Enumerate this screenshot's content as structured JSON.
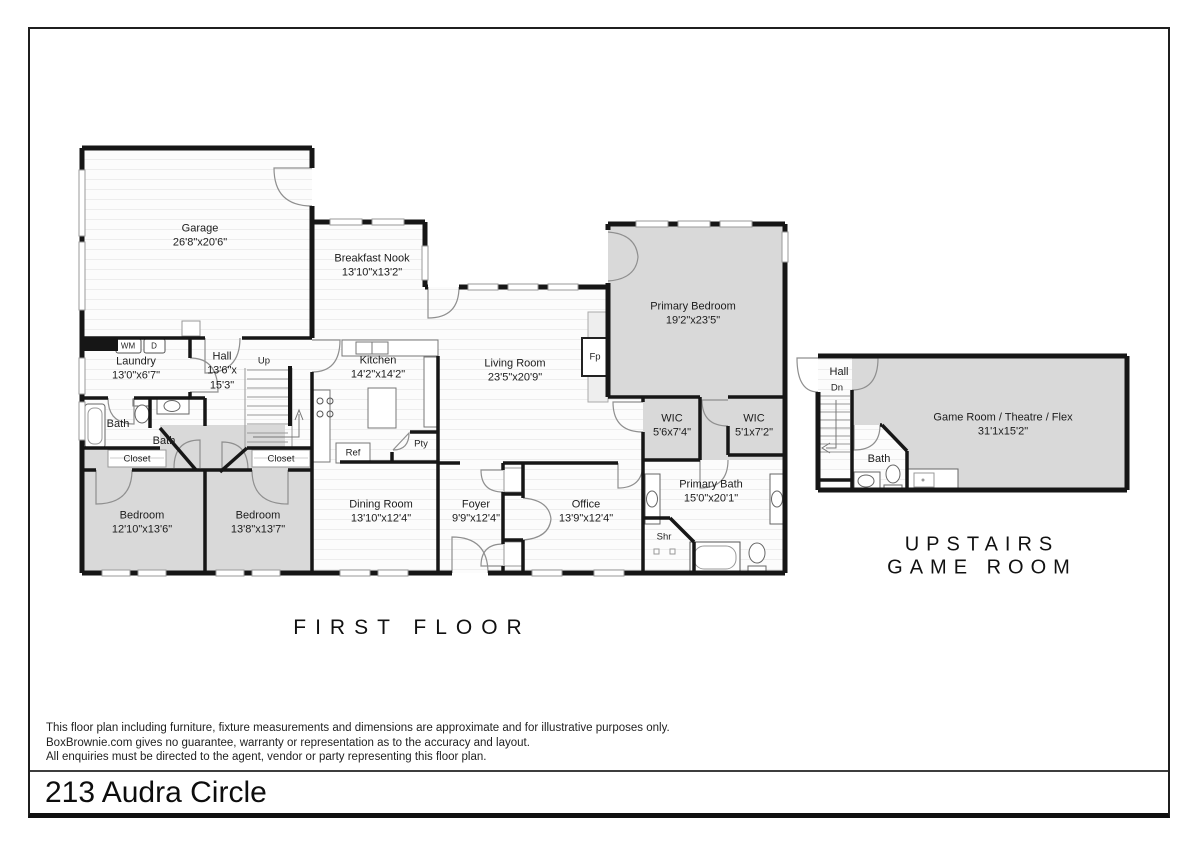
{
  "footer": {
    "address": "213 Audra Circle",
    "disclaimer": [
      "This floor plan including furniture, fixture measurements and dimensions are approximate and for illustrative purposes only.",
      "BoxBrownie.com gives no guarantee, warranty or representation as to the accuracy and layout.",
      "All enquiries must be directed to the agent, vendor or party representing this floor plan."
    ]
  },
  "sections": {
    "first_floor": "FIRST FLOOR",
    "upstairs_line1": "UPSTAIRS",
    "upstairs_line2": "GAME ROOM"
  },
  "rooms": {
    "garage": {
      "name": "Garage",
      "dims": "26'8\"x20'6\""
    },
    "breakfast_nook": {
      "name": "Breakfast Nook",
      "dims": "13'10\"x13'2\""
    },
    "kitchen": {
      "name": "Kitchen",
      "dims": "14'2\"x14'2\""
    },
    "living_room": {
      "name": "Living Room",
      "dims": "23'5\"x20'9\""
    },
    "primary_bedroom": {
      "name": "Primary Bedroom",
      "dims": "19'2\"x23'5\""
    },
    "laundry": {
      "name": "Laundry",
      "dims": "13'0\"x6'7\""
    },
    "hall": {
      "name": "Hall",
      "dims": "13'6\"x 15'3\""
    },
    "wic_left": {
      "name": "WIC",
      "dims": "5'6x7'4\""
    },
    "wic_right": {
      "name": "WIC",
      "dims": "5'1x7'2\""
    },
    "primary_bath": {
      "name": "Primary Bath",
      "dims": "15'0\"x20'1\""
    },
    "bedroom_left": {
      "name": "Bedroom",
      "dims": "12'10\"x13'6\""
    },
    "bedroom_right": {
      "name": "Bedroom",
      "dims": "13'8\"x13'7\""
    },
    "dining_room": {
      "name": "Dining Room",
      "dims": "13'10\"x12'4\""
    },
    "foyer": {
      "name": "Foyer",
      "dims": "9'9\"x12'4\""
    },
    "office": {
      "name": "Office",
      "dims": "13'9\"x12'4\""
    },
    "game_room": {
      "name": "Game Room / Theatre / Flex",
      "dims": "31'1x15'2\""
    },
    "bath_left": {
      "name": "Bath"
    },
    "bath_mid": {
      "name": "Bath"
    },
    "upstairs_hall": {
      "name": "Hall"
    },
    "upstairs_bath": {
      "name": "Bath"
    }
  },
  "fixtures": {
    "washing_machine": "WM",
    "dryer": "D",
    "up": "Up",
    "down": "Dn",
    "refrigerator": "Ref",
    "pantry": "Pty",
    "fireplace": "Fp",
    "shower": "Shr",
    "closet_left": "Closet",
    "closet_right": "Closet"
  },
  "colors": {
    "wall": "#161616",
    "carpet": "#d9d9d9",
    "floor": "#fcfcfc"
  }
}
